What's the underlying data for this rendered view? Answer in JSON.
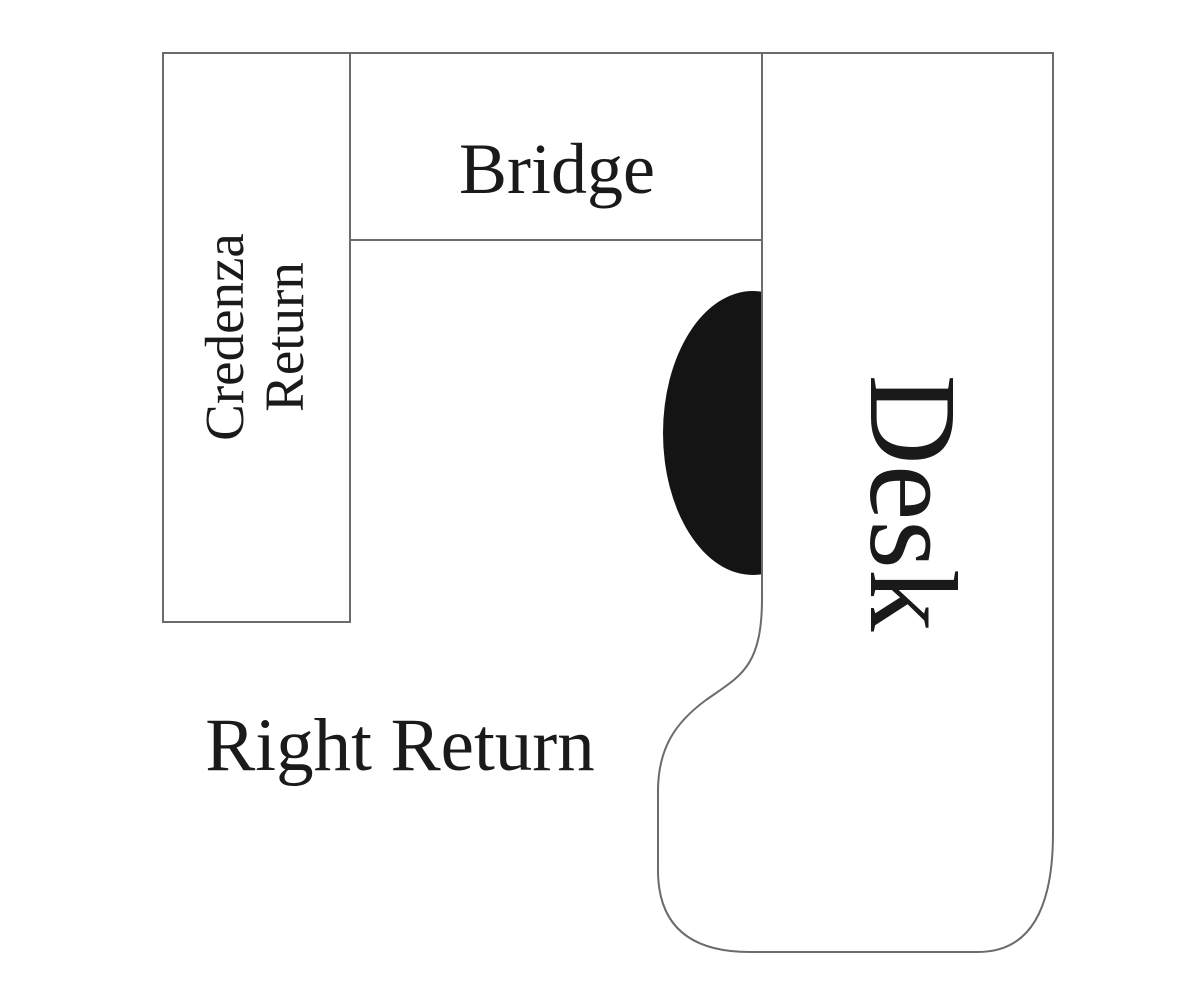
{
  "labels": {
    "bridge": "Bridge",
    "credenza_line1": "Credenza",
    "credenza_line2": "Return",
    "desk": "Desk",
    "right_return": "Right Return"
  },
  "colors": {
    "outline": "#6b6b6b",
    "text": "#1a1a1a",
    "chair": "#141414",
    "background": "#ffffff"
  }
}
